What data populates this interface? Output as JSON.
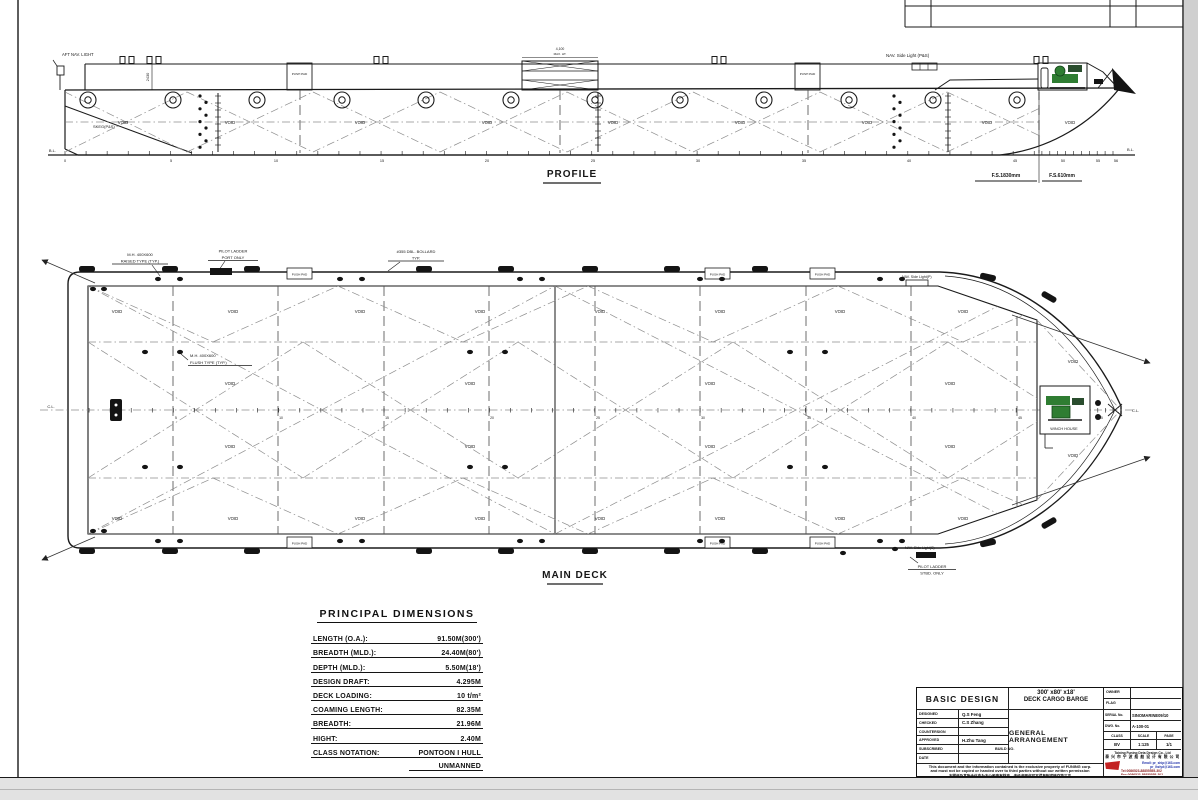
{
  "colors": {
    "winch_green": "#2f7d32",
    "logo_red": "#c32222",
    "email_blue": "#2233aa",
    "contact_red": "#8a1a1a"
  },
  "profile": {
    "title": "PROFILE",
    "labels": {
      "aft_nav_light": "AFT NAV. LIGHT",
      "skeg": "SKEG(P&S)",
      "coaming_height": "2430",
      "push_pad": "PUSH PAD",
      "mast_height": "4,100",
      "mast_height_2": "MAX. HT.",
      "nav_side_light": "NAV. Side Light (P&S)",
      "void": "VOID",
      "bl": "B.L.",
      "fs_1830": "F.S.1830mm",
      "fs_610": "F.S.610mm"
    },
    "frame_numbers": [
      "0",
      "5",
      "10",
      "15",
      "20",
      "25",
      "30",
      "35",
      "40",
      "45",
      "50",
      "55",
      "56"
    ]
  },
  "main_deck": {
    "title": "MAIN DECK",
    "labels": {
      "mh_raised_1": "M.H. 400X600",
      "mh_raised_2": "RAISED TYPE (TYP.)",
      "pilot_port_1": "PILOT LADDER",
      "pilot_port_2": "PORT ONLY",
      "dbl_bollard_1": "#355 DBL. BOLLARD",
      "dbl_bollard_2": "TYP.",
      "mh_flush_1": "M.H. 400X600",
      "mh_flush_2": "FLUSH TYPE (TYP.)",
      "nav_light_p": "NAV. Side Light(P)",
      "nav_light_s": "NAV. Side Light(S)",
      "pilot_stbd_1": "PILOT LADDER",
      "pilot_stbd_2": "STBD. ONLY",
      "winch_house": "WINCH HOUSE",
      "push_pad": "PUSH PAD",
      "void": "VOID",
      "cl": "C.L."
    },
    "frame_numbers": [
      "5",
      "10",
      "15",
      "20",
      "25",
      "30",
      "35",
      "40",
      "45",
      "50",
      "55"
    ]
  },
  "principal_dimensions": {
    "title": "PRINCIPAL  DIMENSIONS",
    "rows": [
      {
        "label": "LENGTH  (O.A.):",
        "value": "91.50M(300')"
      },
      {
        "label": "BREADTH (MLD.):",
        "value": "24.40M(80')"
      },
      {
        "label": "DEPTH  (MLD.):",
        "value": "5.50M(18')"
      },
      {
        "label": "DESIGN DRAFT:",
        "value": "4.295M"
      },
      {
        "label": "DECK LOADING:",
        "value": "10 t/m²"
      },
      {
        "label": "COAMING LENGTH:",
        "value": "82.35M"
      },
      {
        "label": "BREADTH:",
        "value": "21.96M"
      },
      {
        "label": "HIGHT:",
        "value": "2.40M"
      },
      {
        "label": "CLASS NOTATION:",
        "value": "PONTOON I HULL"
      },
      {
        "label": "",
        "value": "UNMANNED"
      }
    ]
  },
  "title_block": {
    "basic_design": "BASIC DESIGN",
    "rows": [
      {
        "label": "DESIGNED",
        "value": "Q.S Feng"
      },
      {
        "label": "CHECKED",
        "value": "C.S Zhang"
      },
      {
        "label": "COUNTERSIGN",
        "value": ""
      },
      {
        "label": "APPROVED",
        "value": "H.Zhu Tang"
      },
      {
        "label": "SUBSCRIBED",
        "value": ""
      },
      {
        "label": "DATE",
        "value": ""
      }
    ],
    "size_title_1": "300' x80' x18'",
    "size_title_2": "DECK CARGO BARGE",
    "drawing_title": "GENERAL  ARRANGEMENT",
    "build_no_label": "BUILD NO.",
    "owner_label": "OWNER",
    "flag_label": "FLAG",
    "serial_label": "SERIAL No.",
    "serial_value": "SINOMARINE09/10",
    "dwg_label": "DWG. No.",
    "dwg_value": "A-100-01",
    "class_label": "CLASS",
    "class_value": "BV",
    "scale_label": "SCALE",
    "scale_value": "1:125",
    "page_label": "PAGE",
    "page_value": "1/1",
    "disclaimer_1": "This document and the information contained is the exclusive property of FUNING corp.",
    "disclaimer_2": "and must not be copied or handed over to third parties without our written permission",
    "disclaimer_cn": "本图纸及其所含信息为本公司专有财产，未经书面许可不得复制或转交第三方",
    "company_en": "Taixing Funing Deta Design Co., Ltd",
    "company_cn": "泰 兴 市 宁 波 船 舶 设 计 有 限 公 司",
    "email_1": "Email: pr_ship@163.com",
    "email_2": "pr_lhzlyd@163.com",
    "tel": "Tel:0086523-88855555-302",
    "fax": "Fax:0086523-88855555-302",
    "area": "AREA:0.30m²"
  }
}
